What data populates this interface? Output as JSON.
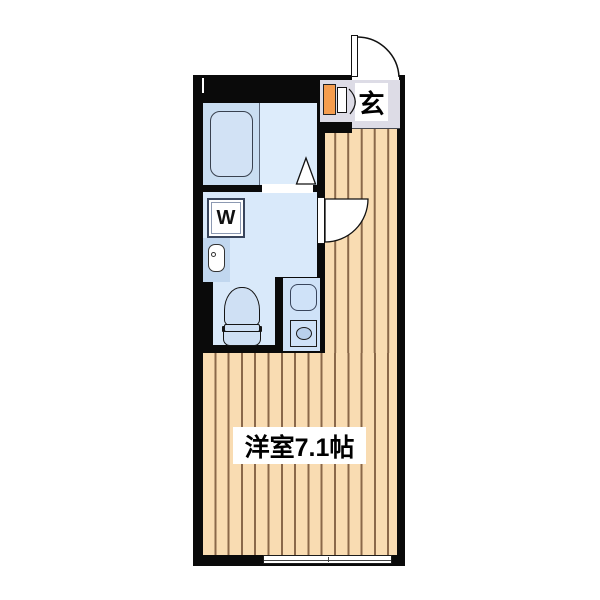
{
  "plan": {
    "type": "floor-plan",
    "labels": {
      "entrance": "玄",
      "main_room": "洋室7.1帖",
      "washing_machine": "W"
    },
    "colors": {
      "wall": "#0a0a0a",
      "wood_floor": "#f9dcb2",
      "wood_stripe": "#8a684a",
      "entrance_floor": "#dddce6",
      "bathtub_room_floor": "#cadef2",
      "bath_floor": "#ddecfb",
      "utility_floor": "#d9e9fa",
      "kitchen_floor": "#cfe2f8",
      "fixture_fill": "#cfe0f4",
      "shoe_cabinet": "#f59d4e",
      "burner_ring": "#b9d0ec"
    },
    "icons": {
      "entrance-door-swing-icon": "quarter-circle arc",
      "closet-door-swing-icon": "small arc",
      "room-door-swing-icon": "white quarter fan",
      "bathroom-door-triangle-icon": "white triangle",
      "bathtub-icon": "rounded rectangle",
      "washing-machine-icon": "square with W",
      "washbasin-icon": "pill with faucet dot",
      "toilet-icon": "bowl with tank",
      "kitchen-sink-icon": "rounded square",
      "stove-burner-icon": "square with oval",
      "sliding-window-icon": "double-line band"
    }
  }
}
